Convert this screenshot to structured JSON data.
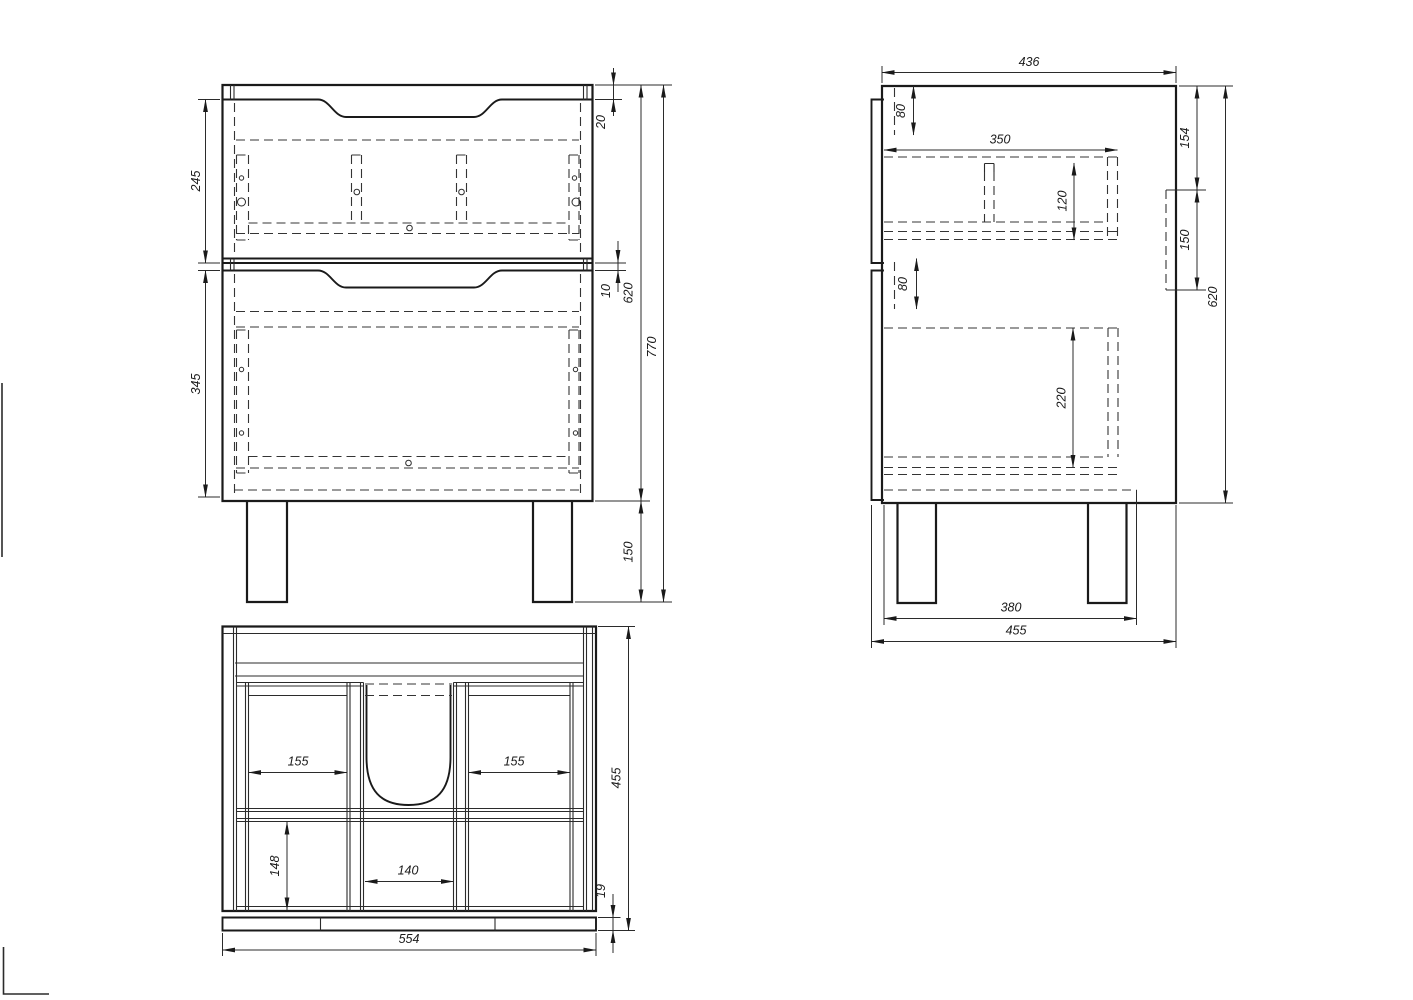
{
  "sheet": {
    "background_color": "#ffffff",
    "line_color": "#1a1a1a"
  },
  "front_view": {
    "dims": {
      "top_rail": "20",
      "drawer1_front_height": "245",
      "front_gap": "10",
      "drawer2_front_height": "345",
      "body_height": "620",
      "total_height": "770",
      "leg_height": "150"
    }
  },
  "side_view": {
    "dims": {
      "body_depth": "436",
      "top_front_offset": "80",
      "drawer_box_depth": "350",
      "drawer1_box_height": "120",
      "hanger_top_offset": "154",
      "hanger_height": "150",
      "bottom_front_offset": "80",
      "drawer2_box_height": "220",
      "body_height": "620",
      "leg_span": "380",
      "total_depth": "455"
    }
  },
  "top_view": {
    "dims": {
      "left_bay_width": "155",
      "right_bay_width": "155",
      "back_bay_depth": "148",
      "center_bay_width": "140",
      "total_depth": "455",
      "plinth_height": "19",
      "total_width": "554"
    }
  }
}
